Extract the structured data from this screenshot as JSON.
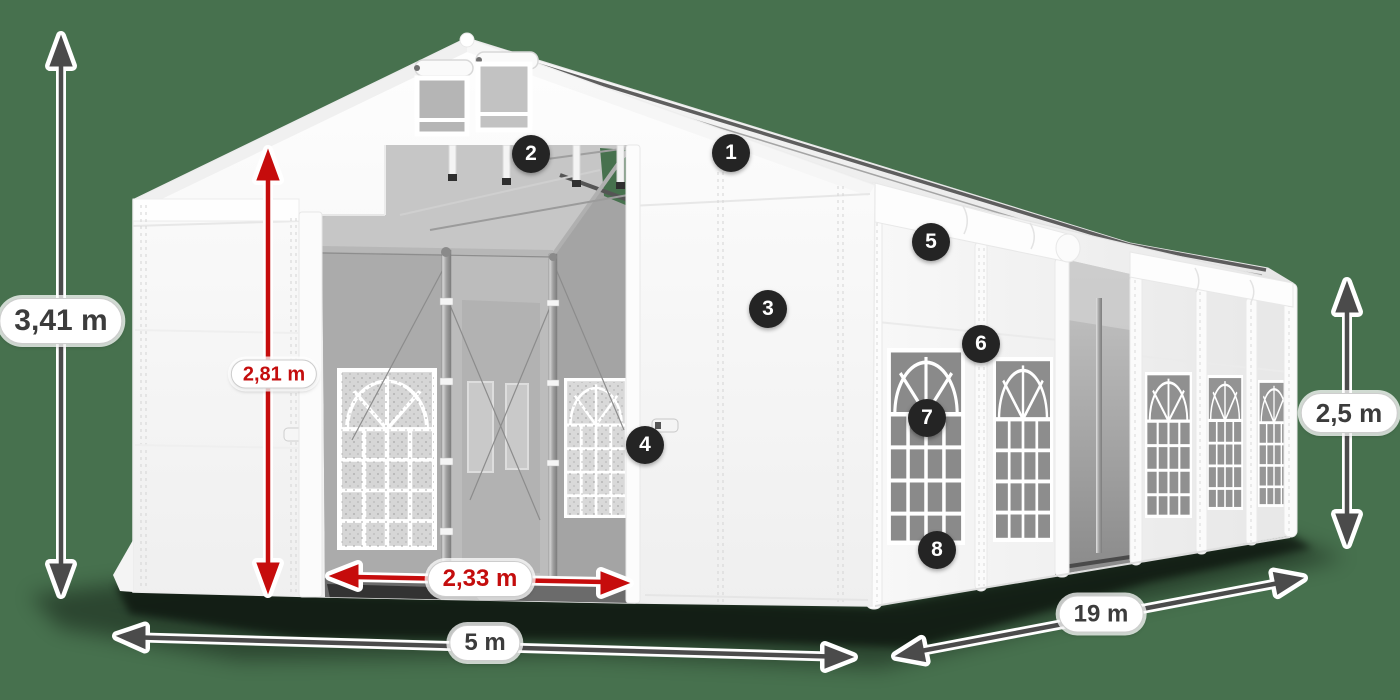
{
  "scene": {
    "background_color": "#47714E",
    "subject": "white party tent 3d diagram"
  },
  "dimension_labels": {
    "total_height": "3,41 m",
    "entrance_height": "2,81 m",
    "entrance_width": "2,33 m",
    "front_width": "5 m",
    "side_length": "19 m",
    "side_wall_height": "2,5 m"
  },
  "feature_badges": [
    "1",
    "2",
    "3",
    "4",
    "5",
    "6",
    "7",
    "8"
  ],
  "colors": {
    "background": "#47714E",
    "tent_white": "#FFFFFF",
    "glass_gray": "#8A8A8A",
    "accent_red": "#C60C0C",
    "arrow_gray": "#4B4B4B",
    "badge_background": "#242424",
    "pill_border": "#CDCDCD",
    "dark_text": "#3C3C3C"
  }
}
